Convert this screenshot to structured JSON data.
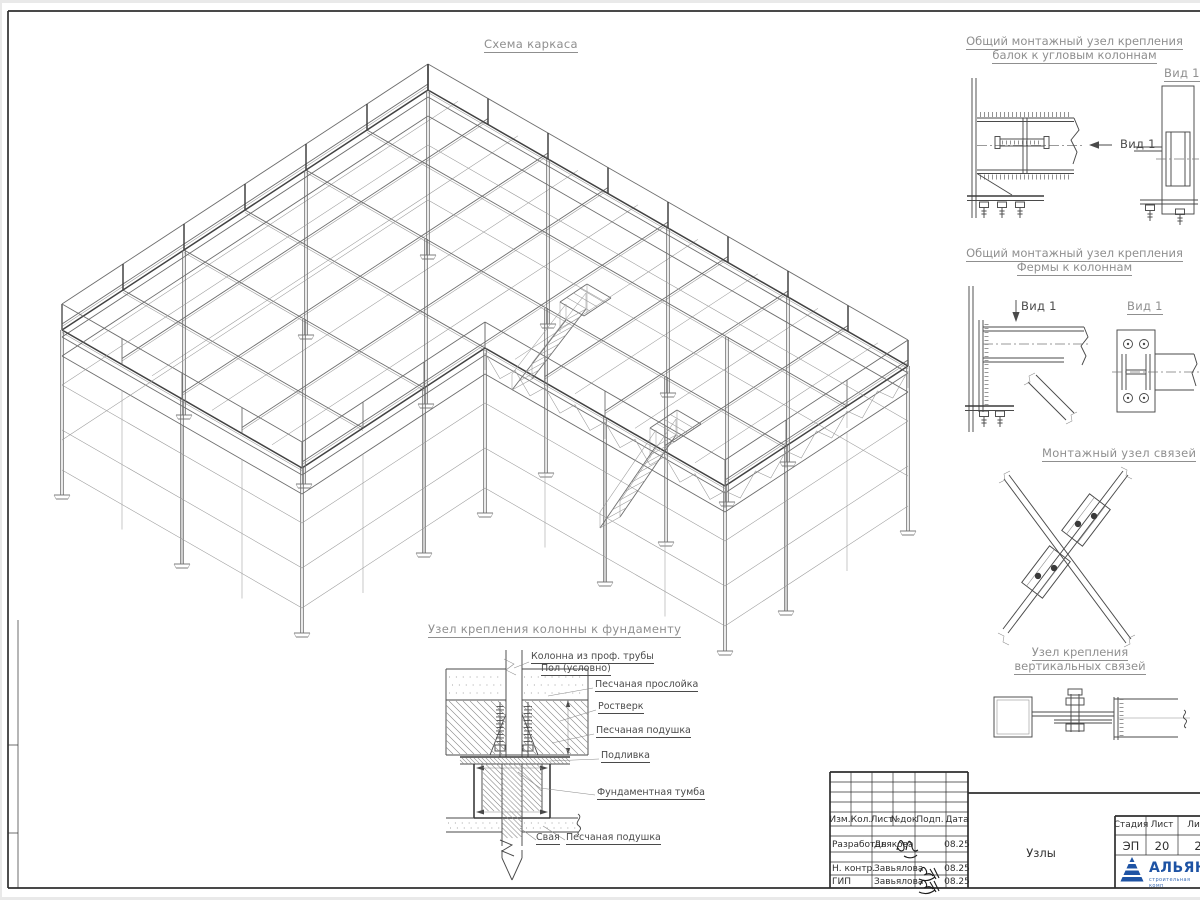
{
  "page": {
    "main_title": "Схема каркаса",
    "details": {
      "corner_beam": {
        "title1": "Общий монтажный узел крепления",
        "title2": "балок к угловым колоннам",
        "view_ref": "Вид 1",
        "view_title": "Вид 1"
      },
      "truss": {
        "title1": "Общий монтажный узел крепления",
        "title2": "Фермы к колоннам",
        "view_ref": "Вид 1",
        "view_title": "Вид 1"
      },
      "brace": {
        "title": "Монтажный узел связей"
      },
      "vbrace": {
        "title1": "Узел крепления",
        "title2": "вертикальных связей"
      },
      "foundation": {
        "title": "Узел крепления колонны к фундаменту",
        "labels": {
          "column": "Колонна из проф. трубы",
          "floor": "Пол (условно)",
          "sand_layer": "Песчаная прослойка",
          "grillage": "Ростверк",
          "sand_cushion": "Песчаная подушка",
          "grout": "Подливка",
          "pedestal": "Фундаментная тумба",
          "pile": "Свая",
          "sand_cushion2": "Песчаная подушка"
        }
      }
    },
    "titleblock": {
      "col_headers": [
        "Изм.",
        "Кол.",
        "Лист",
        "№док",
        "Подп.",
        "Дата"
      ],
      "sign_rows": [
        {
          "role": "Разработал",
          "name": "Дьякова",
          "date": "08.25"
        },
        {
          "role": "Н. контр.",
          "name": "Завьялова",
          "date": "08.25"
        },
        {
          "role": "ГИП",
          "name": "Завьялова",
          "date": "08.25"
        }
      ],
      "stage_label": "Стадия",
      "sheet_label": "Лист",
      "sheets_label": "Лис",
      "stage_value": "ЭП",
      "sheet_value": "20",
      "sheets_value": "2",
      "doc_name": "Узлы",
      "logo_text": "АЛЬЯН",
      "logo_subtext": "строительная комп"
    },
    "colors": {
      "line": "#4a4a4a",
      "title_text": "#8f8f8f",
      "logo_blue": "#1e53a4"
    }
  }
}
